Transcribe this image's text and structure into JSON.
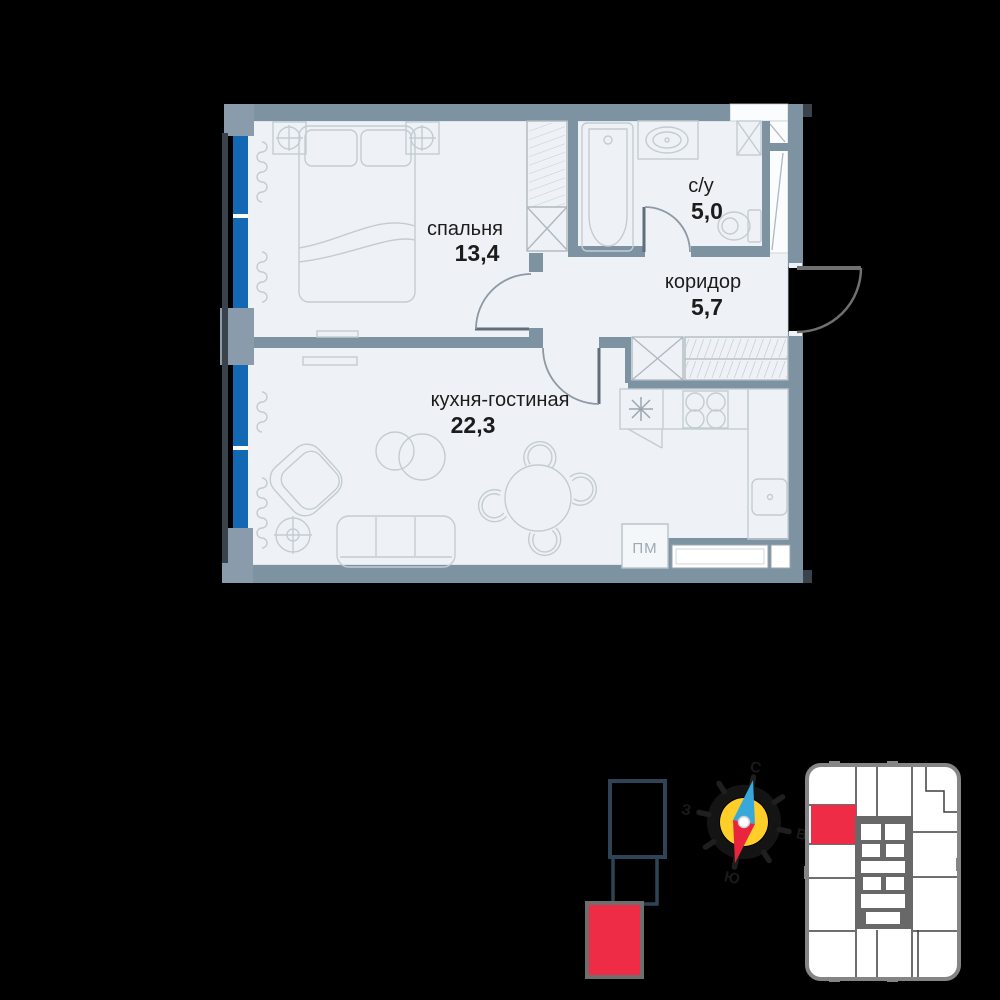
{
  "canvas": {
    "background": "#000000"
  },
  "floor_plan": {
    "rooms": [
      {
        "key": "bedroom",
        "label": "спальня",
        "area": "13,4"
      },
      {
        "key": "bathroom",
        "label": "с/у",
        "area": "5,0"
      },
      {
        "key": "corridor",
        "label": "коридор",
        "area": "5,7"
      },
      {
        "key": "kitchen_living",
        "label": "кухня-гостиная",
        "area": "22,3"
      }
    ],
    "appliance_label": "ПМ",
    "colors": {
      "interior": "#eef2f6",
      "wall": "#7e93a2",
      "wall_block": "#8a9cab",
      "outer_frame": "#3a434b",
      "glazing": "#1268b2",
      "furniture_line": "#c3ccd2",
      "door_leaf": "#5f6e7a",
      "label_text": "#1c1c1c"
    }
  },
  "compass": {
    "north": "С",
    "east": "В",
    "south": "Ю",
    "west": "З",
    "colors": {
      "disc": "#ffce29",
      "needle_north": "#38a8da",
      "needle_south": "#e8253c"
    }
  },
  "building_stack": {
    "outline_color": "#2e4456",
    "highlight_color": "#ee2c45"
  },
  "floor_minimap": {
    "outline_color": "#858585",
    "core_color": "#686868",
    "unit_color": "#ffffff",
    "highlight_color": "#ee2c45"
  }
}
